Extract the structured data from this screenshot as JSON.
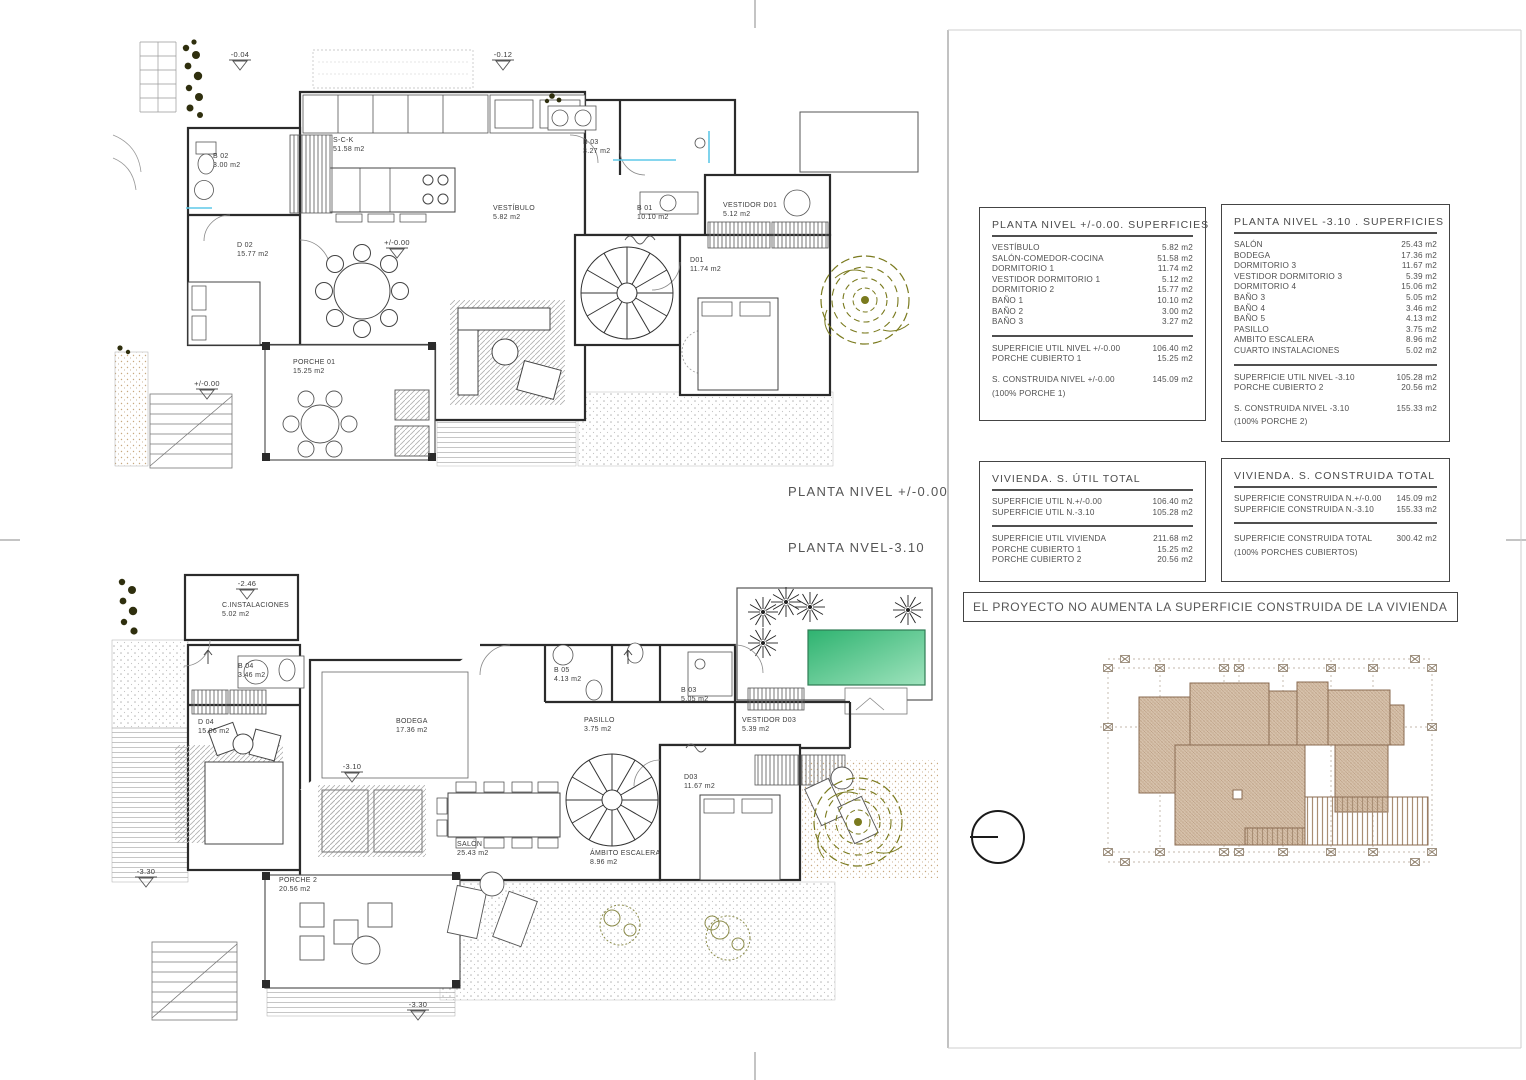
{
  "sheet": {
    "titles": {
      "plan_upper": "PLANTA NIVEL +/-0.00",
      "plan_lower": "PLANTA NVEL-3.10"
    },
    "banner": "EL PROYECTO NO AUMENTA LA SUPERFICIE CONSTRUIDA DE LA VIVIENDA"
  },
  "tables": {
    "nivel_0": {
      "title": "PLANTA NIVEL +/-0.00. SUPERFICIES",
      "rows": [
        {
          "l": "VESTÍBULO",
          "v": "5.82 m2"
        },
        {
          "l": "SALÓN-COMEDOR-COCINA",
          "v": "51.58 m2"
        },
        {
          "l": "DORMITORIO 1",
          "v": "11.74 m2"
        },
        {
          "l": "VESTIDOR DORMITORIO 1",
          "v": "5.12 m2"
        },
        {
          "l": "DORMITORIO 2",
          "v": "15.77 m2"
        },
        {
          "l": "BAÑO 1",
          "v": "10.10 m2"
        },
        {
          "l": "BAÑO 2",
          "v": "3.00 m2"
        },
        {
          "l": "BAÑO 3",
          "v": "3.27 m2"
        },
        {
          "sep": true
        },
        {
          "l": "SUPERFICIE UTIL NIVEL +/-0.00",
          "v": "106.40 m2"
        },
        {
          "l": "PORCHE CUBIERTO 1",
          "v": "15.25 m2"
        },
        {
          "l": "S. CONSTRUIDA NIVEL +/-0.00",
          "v": "145.09 m2",
          "gap": true
        },
        {
          "note": "(100% PORCHE 1)"
        }
      ]
    },
    "nivel_310": {
      "title": "PLANTA NIVEL -3.10 . SUPERFICIES",
      "rows": [
        {
          "l": "SALÓN",
          "v": "25.43 m2"
        },
        {
          "l": "BODEGA",
          "v": "17.36 m2"
        },
        {
          "l": "DORMITORIO 3",
          "v": "11.67 m2"
        },
        {
          "l": "VESTIDOR DORMITORIO 3",
          "v": "5.39 m2"
        },
        {
          "l": "DORMITORIO 4",
          "v": "15.06 m2"
        },
        {
          "l": "BAÑO 3",
          "v": "5.05 m2"
        },
        {
          "l": "BAÑO 4",
          "v": "3.46 m2"
        },
        {
          "l": "BAÑO 5",
          "v": "4.13 m2"
        },
        {
          "l": "PASILLO",
          "v": "3.75 m2"
        },
        {
          "l": "AMBITO ESCALERA",
          "v": "8.96 m2"
        },
        {
          "l": "CUARTO INSTALACIONES",
          "v": "5.02 m2"
        },
        {
          "sep": true
        },
        {
          "l": "SUPERFICIE UTIL NIVEL -3.10",
          "v": "105.28 m2"
        },
        {
          "l": "PORCHE CUBIERTO 2",
          "v": "20.56 m2"
        },
        {
          "l": "S. CONSTRUIDA NIVEL -3.10",
          "v": "155.33 m2",
          "gap": true
        },
        {
          "note": "(100% PORCHE 2)"
        }
      ]
    },
    "util_total": {
      "title": "VIVIENDA. S. ÚTIL TOTAL",
      "rows": [
        {
          "l": "SUPERFICIE UTIL N.+/-0.00",
          "v": "106.40 m2"
        },
        {
          "l": "SUPERFICIE UTIL N.-3.10",
          "v": "105.28 m2"
        },
        {
          "sep": true
        },
        {
          "l": "SUPERFICIE UTIL VIVIENDA",
          "v": "211.68 m2"
        },
        {
          "l": "PORCHE CUBIERTO 1",
          "v": "15.25 m2"
        },
        {
          "l": "PORCHE CUBIERTO 2",
          "v": "20.56 m2"
        }
      ]
    },
    "construida_total": {
      "title": "VIVIENDA. S. CONSTRUIDA TOTAL",
      "rows": [
        {
          "l": "SUPERFICIE CONSTRUIDA N.+/-0.00",
          "v": "145.09 m2"
        },
        {
          "l": "SUPERFICIE CONSTRUIDA N.-3.10",
          "v": "155.33 m2"
        },
        {
          "sep": true
        },
        {
          "l": "SUPERFICIE CONSTRUIDA  TOTAL",
          "v": "300.42 m2",
          "gap": true
        },
        {
          "note": "(100% PORCHES CUBIERTOS)"
        }
      ]
    }
  },
  "plans": {
    "upper": {
      "rooms": [
        {
          "name": "B 02",
          "area": "3.00 m2"
        },
        {
          "name": "S-C-K",
          "area": "51.58 m2"
        },
        {
          "name": "D 02",
          "area": "15.77 m2"
        },
        {
          "name": "VESTÍBULO",
          "area": "5.82 m2"
        },
        {
          "name": "B 03",
          "area": "3.27 m2"
        },
        {
          "name": "B 01",
          "area": "10.10 m2"
        },
        {
          "name": "VESTIDOR D01",
          "area": "5.12 m2"
        },
        {
          "name": "D01",
          "area": "11.74 m2"
        },
        {
          "name": "PORCHE 01",
          "area": "15.25 m2"
        }
      ],
      "levels": [
        "-0.04",
        "-0.12",
        "+/-0.00",
        "+/-0.00"
      ]
    },
    "lower": {
      "rooms": [
        {
          "name": "C.INSTALACIONES",
          "area": "5.02 m2"
        },
        {
          "name": "B 04",
          "area": "3.46 m2"
        },
        {
          "name": "D 04",
          "area": "15.06 m2"
        },
        {
          "name": "BODEGA",
          "area": "17.36 m2"
        },
        {
          "name": "B 05",
          "area": "4.13 m2"
        },
        {
          "name": "B 03",
          "area": "5.05 m2"
        },
        {
          "name": "PASILLO",
          "area": "3.75 m2"
        },
        {
          "name": "VESTIDOR D03",
          "area": "5.39 m2"
        },
        {
          "name": "SALÓN",
          "area": "25.43 m2"
        },
        {
          "name": "ÁMBITO ESCALERA",
          "area": "8.96 m2"
        },
        {
          "name": "D03",
          "area": "11.67 m2"
        },
        {
          "name": "PORCHE 2",
          "area": "20.56 m2"
        }
      ],
      "levels": [
        "-2.46",
        "-3.10",
        "-3.30",
        "-3.30"
      ]
    }
  },
  "colors": {
    "pool_green_dark": "#2eb370",
    "pool_green_light": "#9fe3bd",
    "roof_tan": "#d6c1ab",
    "roof_line": "#8a6b52",
    "plant_olive": "#7a7a1e",
    "accent_cyan": "#5fc8e8"
  }
}
